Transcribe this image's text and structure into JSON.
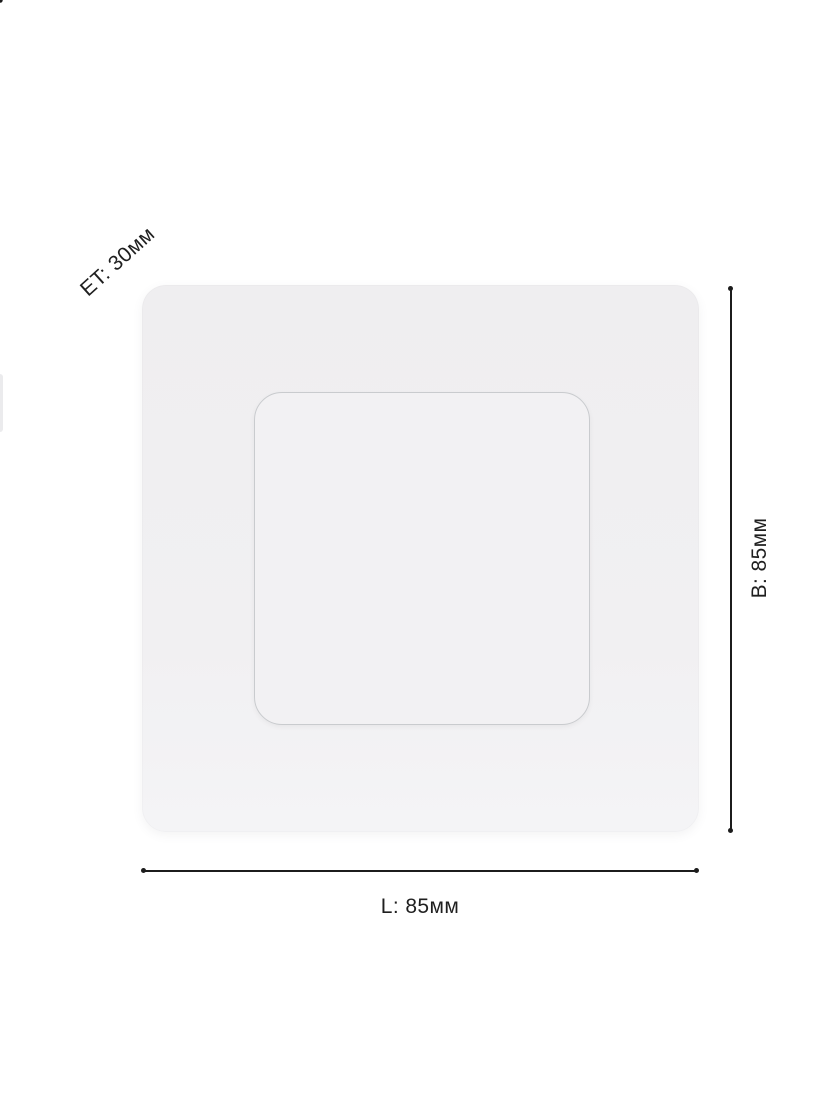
{
  "diagram": {
    "type": "product-dimension-diagram",
    "product": "square recessed panel (top view)",
    "dimensions": {
      "edge_thickness_label": "ET: 30мм",
      "height_label": "B: 85мм",
      "length_label": "L: 85мм"
    },
    "colors": {
      "line": "#1c1c1c",
      "text": "#1f1f1f",
      "panel_fill": "#f0eff1",
      "inner_fill": "#f2f1f3",
      "inner_border": "#c9cbce",
      "background": "#ffffff"
    }
  }
}
